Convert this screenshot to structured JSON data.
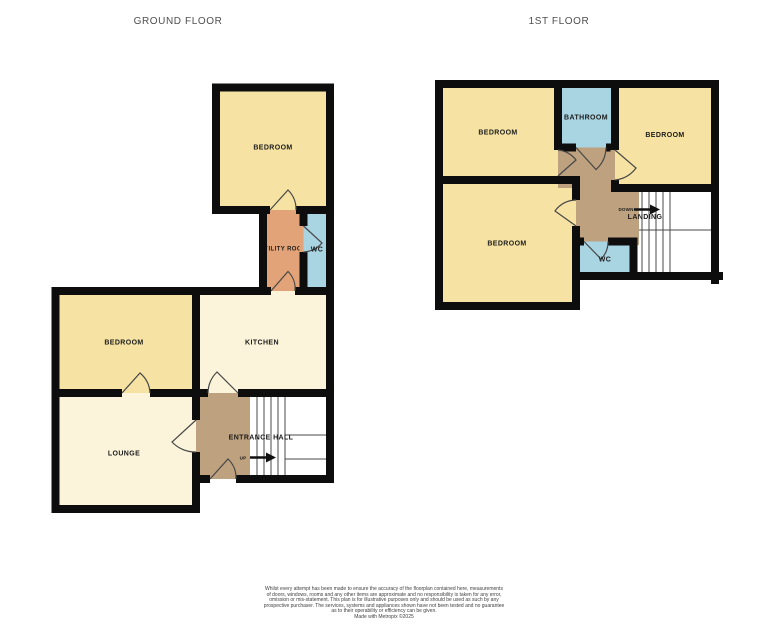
{
  "titles": {
    "ground_floor": "GROUND FLOOR",
    "first_floor": "1ST FLOOR"
  },
  "ground_floor": {
    "rooms": {
      "bedroom_top": "BEDROOM",
      "utility_room": "UTILITY ROOM",
      "wc": "WC",
      "bedroom": "BEDROOM",
      "kitchen": "KITCHEN",
      "lounge": "LOUNGE",
      "entrance_hall": "ENTRANCE HALL"
    },
    "stairs": {
      "direction_label": "UP"
    }
  },
  "first_floor": {
    "rooms": {
      "bedroom_top_left": "BEDROOM",
      "bathroom": "BATHROOM",
      "bedroom_top_right": "BEDROOM",
      "bedroom_large": "BEDROOM",
      "landing": "LANDING",
      "wc": "WC"
    },
    "stairs": {
      "direction_label": "DOWN"
    }
  },
  "colors": {
    "wall": "#0D0D0D",
    "bedroom_fill": "#F6E3A3",
    "living_fill": "#FBF3DA",
    "utility_fill": "#E1A377",
    "wet_room_fill": "#A9D4E2",
    "hall_fill": "#BEA17E",
    "stairs_fill": "#FFFFFF",
    "stair_line": "#4A4A4A",
    "door_line": "#474747",
    "label_text": "#1B1B1B",
    "arrow": "#111111"
  },
  "disclaimer": {
    "lines": [
      "Whilst every attempt has been made to ensure the accuracy of the floorplan contained here, measurements",
      "of doors, windows, rooms and any other items are approximate and no responsibility is taken for any error,",
      "omission or mis-statement. This plan is for illustrative purposes only and should be used as such by any",
      "prospective purchaser. The services, systems and appliances shown have not been tested and no guarantee",
      "as to their operability or efficiency can be given.",
      "Made with Metropix ©2025"
    ]
  }
}
